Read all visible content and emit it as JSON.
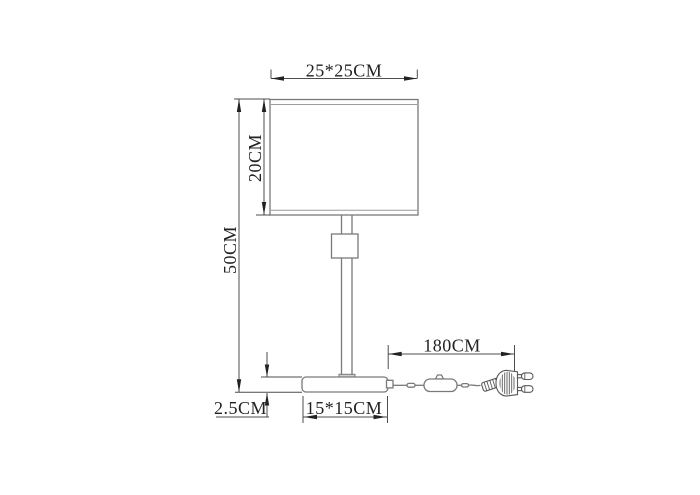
{
  "drawing": {
    "type": "technical-dimension-diagram",
    "subject": "table lamp with rectangular shade, stem base, inline cord switch and EU plug",
    "colors": {
      "background": "#ffffff",
      "outline": "#7a7a7a",
      "dimension_lines": "#4d4d4d",
      "arrows_and_text": "#222222"
    },
    "labels": {
      "shade_width": "25*25CM",
      "shade_height": "20CM",
      "total_height": "50CM",
      "base_thickness": "2.5CM",
      "base_size": "15*15CM",
      "cable_length": "180CM"
    }
  }
}
